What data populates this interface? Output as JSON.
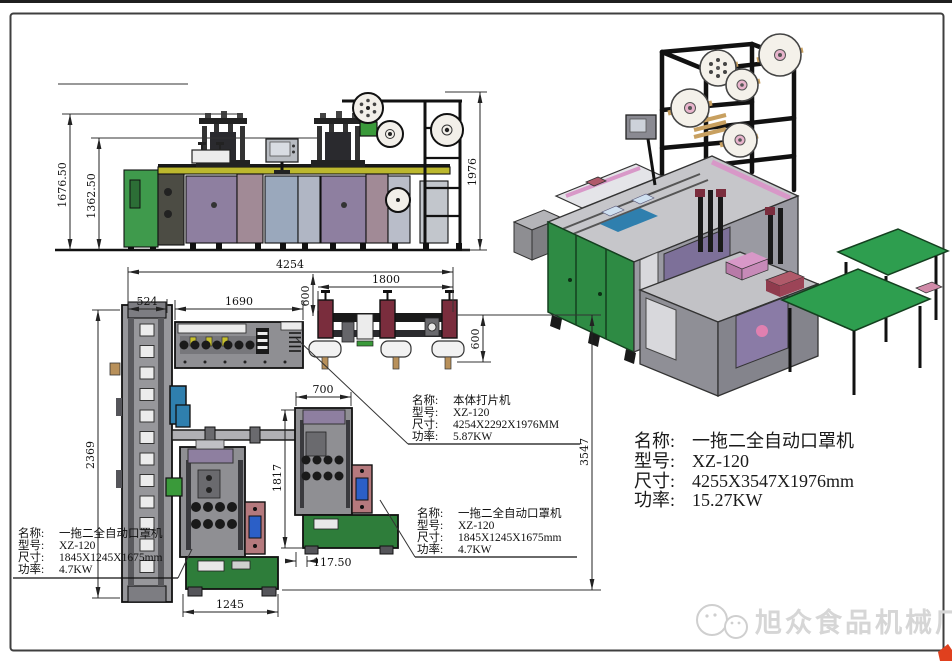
{
  "watermark": {
    "text": "旭众食品机械厂"
  },
  "labels": {
    "name": "名称:",
    "model": "型号:",
    "size": "尺寸:",
    "power": "功率:"
  },
  "blocks": {
    "body_cutter": {
      "name": "本体打片机",
      "model": "XZ-120",
      "size": "4254X2292X1976MM",
      "power": "5.87KW"
    },
    "right_mask_unit": {
      "name": "一拖二全自动口罩机",
      "model": "XZ-120",
      "size": "1845X1245X1675mm",
      "power": "4.7KW"
    },
    "left_mask_unit": {
      "name": "一拖二全自动口罩机",
      "model": "XZ-120",
      "size": "1845X1245X1675mm",
      "power": "4.7KW"
    },
    "overall_machine": {
      "name": "一拖二全自动口罩机",
      "model": "XZ-120",
      "size": "4255X3547X1976mm",
      "power": "15.27KW"
    }
  },
  "dims": {
    "front_total_height": "1676.50",
    "front_body_height": "1362.50",
    "front_stand_height": "1976",
    "plan_total_width": "4254",
    "loader_width": "524",
    "body_width": "1690",
    "stand_width": "1800",
    "stand_offset": "600",
    "stand_depth": "600",
    "loader_length": "2369",
    "plan_total_depth": "3547",
    "mask_width": "700",
    "mask_depth": "1817",
    "mask_offset": "117.50",
    "mask_base_width": "1245"
  },
  "palette": {
    "green_cabinet": "#3f9a4c",
    "iso_cabinet_green": "#2e8b44",
    "conveyor_green": "#2e9e4f",
    "base_green": "#2e7d3a",
    "panel_purple": "#8e7fa0",
    "panel_mauve": "#a18a96",
    "panel_bluegray": "#9aa8bc",
    "deck_yellow": "#bcb82e",
    "maroon_unit": "#7a2d3d",
    "pink_unit": "#b5797d",
    "screen_blue": "#2b5fc7",
    "loader_blue": "#2f7fae",
    "iso_door_purple": "#7d7099",
    "iso_pink": "#d898c8",
    "watermark_gray": "#d6d6d6",
    "corner_red": "#e0401e"
  }
}
